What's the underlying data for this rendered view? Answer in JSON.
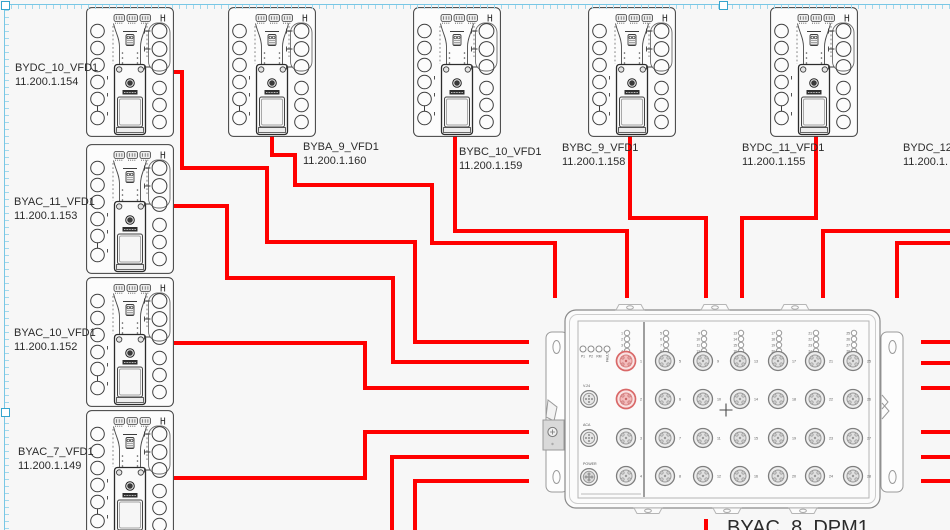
{
  "canvas": {
    "width": 950,
    "height": 530,
    "background": "#f7f7f7"
  },
  "colors": {
    "wire": "#ff0000",
    "selection": "#79c7e5",
    "selection_handle_border": "#35a4cd",
    "device_stroke": "#3d3d3d",
    "dpm_stroke": "#9a9a9a",
    "port_red": "#d96868",
    "label": "#2b2b2b"
  },
  "vfd": {
    "h_label": "H"
  },
  "devices": [
    {
      "name": "BYDC_10_VFD1",
      "ip": "11.200.1.154",
      "x": 86,
      "y": 7,
      "label": {
        "x": 15,
        "y": 61
      }
    },
    {
      "name": "BYAC_11_VFD1",
      "ip": "11.200.1.153",
      "x": 86,
      "y": 144,
      "label": {
        "x": 14,
        "y": 195
      }
    },
    {
      "name": "BYAC_10_VFD1",
      "ip": "11.200.1.152",
      "x": 86,
      "y": 277,
      "label": {
        "x": 14,
        "y": 326
      }
    },
    {
      "name": "BYAC_7_VFD1",
      "ip": "11.200.1.149",
      "x": 86,
      "y": 410,
      "label": {
        "x": 18,
        "y": 445
      }
    },
    {
      "name": "BYBA_9_VFD1",
      "ip": "11.200.1.160",
      "x": 228,
      "y": 7,
      "label": {
        "x": 303,
        "y": 140
      }
    },
    {
      "name": "BYBC_10_VFD1",
      "ip": "11.200.1.159",
      "x": 413,
      "y": 7,
      "label": {
        "x": 459,
        "y": 145
      }
    },
    {
      "name": "BYBC_9_VFD1",
      "ip": "11.200.1.158",
      "x": 588,
      "y": 7,
      "label": {
        "x": 562,
        "y": 141
      }
    },
    {
      "name": "BYDC_11_VFD1",
      "ip": "11.200.1.155",
      "x": 770,
      "y": 7,
      "label": {
        "x": 742,
        "y": 141
      }
    },
    {
      "name": "BYDC_12",
      "ip": "11.200.1.",
      "x": 962,
      "y": 7,
      "label": {
        "x": 903,
        "y": 141
      }
    }
  ],
  "dpm": {
    "name": "BYAC_8_DPM1",
    "x": 545,
    "y": 300,
    "label": {
      "x": 727,
      "y": 516
    },
    "status_leds": [
      "P1",
      "P2",
      "RM",
      "FAULT"
    ],
    "side_connectors": [
      "V.24",
      "ACA",
      "POWER"
    ],
    "port_columns": [
      [
        1,
        2,
        3,
        4
      ],
      [
        5,
        6,
        7,
        8
      ],
      [
        9,
        10,
        11,
        12
      ],
      [
        13,
        14,
        15,
        16
      ],
      [
        17,
        18,
        19,
        20
      ],
      [
        21,
        22,
        23,
        24
      ],
      [
        25,
        26,
        27,
        28
      ]
    ],
    "highlighted_ports": [
      1,
      2
    ]
  },
  "wires": [
    [
      [
        174,
        72
      ],
      [
        182,
        72
      ],
      [
        182,
        168
      ],
      [
        267,
        168
      ],
      [
        267,
        242
      ],
      [
        415,
        242
      ],
      [
        415,
        342
      ],
      [
        529,
        342
      ]
    ],
    [
      [
        174,
        206
      ],
      [
        227,
        206
      ],
      [
        227,
        278
      ],
      [
        393,
        278
      ],
      [
        393,
        362
      ],
      [
        529,
        362
      ]
    ],
    [
      [
        174,
        343
      ],
      [
        365,
        343
      ],
      [
        365,
        388
      ],
      [
        529,
        388
      ]
    ],
    [
      [
        174,
        478
      ],
      [
        365,
        478
      ],
      [
        365,
        432
      ],
      [
        529,
        432
      ]
    ],
    [
      [
        272,
        136
      ],
      [
        272,
        155
      ],
      [
        295,
        155
      ],
      [
        295,
        185
      ],
      [
        432,
        185
      ],
      [
        432,
        243
      ],
      [
        555,
        243
      ],
      [
        555,
        298
      ]
    ],
    [
      [
        455,
        136
      ],
      [
        455,
        231
      ],
      [
        627,
        231
      ],
      [
        627,
        298
      ]
    ],
    [
      [
        630,
        136
      ],
      [
        630,
        218
      ],
      [
        706,
        218
      ],
      [
        706,
        298
      ]
    ],
    [
      [
        816,
        136
      ],
      [
        816,
        218
      ],
      [
        742,
        218
      ],
      [
        742,
        298
      ]
    ],
    [
      [
        952,
        231
      ],
      [
        823,
        231
      ],
      [
        823,
        298
      ]
    ],
    [
      [
        952,
        243
      ],
      [
        897,
        243
      ],
      [
        897,
        298
      ]
    ],
    [
      [
        921,
        342
      ],
      [
        952,
        342
      ]
    ],
    [
      [
        921,
        363
      ],
      [
        952,
        363
      ]
    ],
    [
      [
        921,
        388
      ],
      [
        952,
        388
      ]
    ],
    [
      [
        921,
        432
      ],
      [
        952,
        432
      ]
    ],
    [
      [
        921,
        457
      ],
      [
        952,
        457
      ]
    ],
    [
      [
        921,
        481
      ],
      [
        952,
        481
      ]
    ],
    [
      [
        392,
        532
      ],
      [
        392,
        457
      ],
      [
        529,
        457
      ]
    ],
    [
      [
        415,
        532
      ],
      [
        415,
        481
      ],
      [
        529,
        481
      ]
    ],
    [
      [
        706,
        519
      ],
      [
        706,
        532
      ]
    ]
  ],
  "selection": {
    "handles": [
      {
        "id": "top-left",
        "x": 1,
        "y": 1
      },
      {
        "id": "top-mid",
        "x": 719,
        "y": 1
      },
      {
        "id": "left-mid",
        "x": 1,
        "y": 408
      }
    ]
  }
}
